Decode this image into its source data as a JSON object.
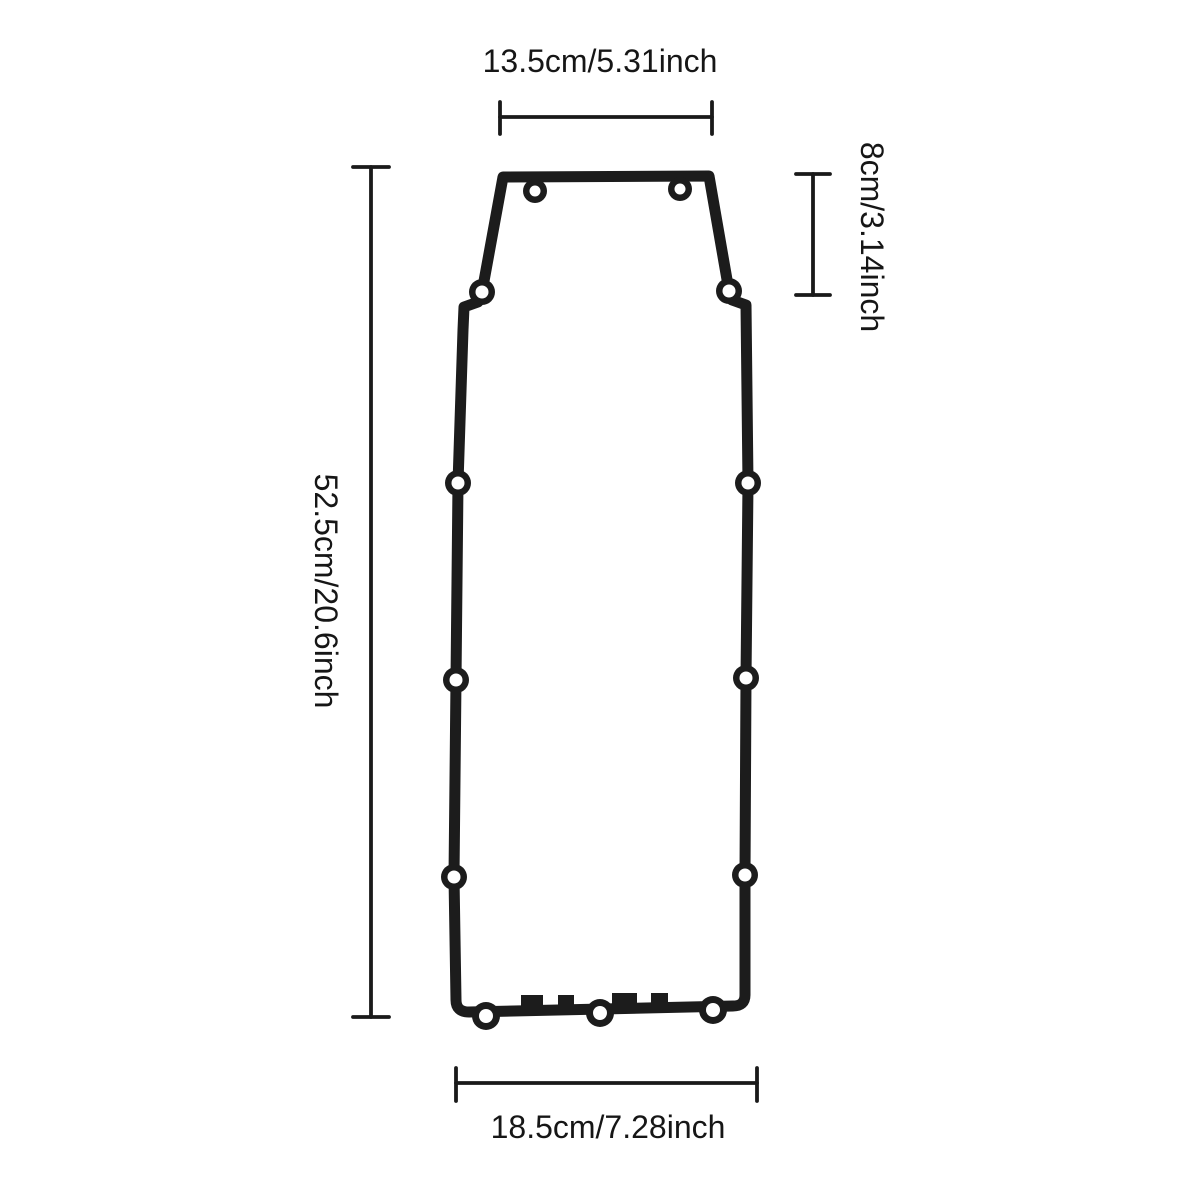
{
  "figure": {
    "type": "technical dimension diagram",
    "subject": "gasket outline with bolt holes",
    "background_color": "#ffffff",
    "line_color": "#1c1c1c",
    "dimension_color": "#1a1a1a"
  },
  "dimensions": {
    "top_width": {
      "label": "13.5cm/5.31inch"
    },
    "overall_height": {
      "label": "52.5cm/20.6inch"
    },
    "top_section_height": {
      "label": "8cm/3.14inch"
    },
    "bottom_width": {
      "label": "18.5cm/7.28inch"
    }
  },
  "bolt_holes": {
    "top_edge": 2,
    "upper_shoulders": 2,
    "left_side": 3,
    "right_side": 3,
    "bottom_edge": 3,
    "total": 13
  }
}
